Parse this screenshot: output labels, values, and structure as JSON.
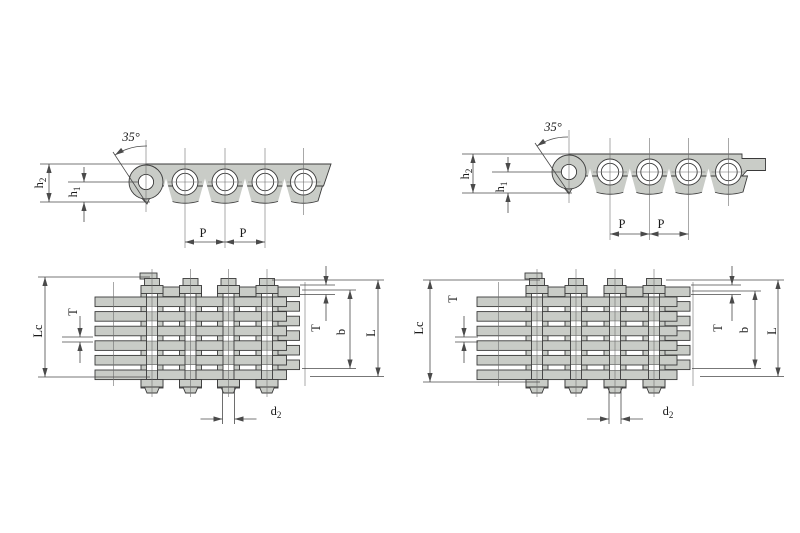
{
  "colors": {
    "plate_fill": "#c9ccc7",
    "outline": "#3a3a3a",
    "dimension": "#4a4a4a",
    "centerline": "#6f6f6f",
    "background": "#ffffff"
  },
  "views": {
    "side_left": {
      "angle": "35°",
      "h2_base": "h",
      "h2_sub": "2",
      "h1_base": "h",
      "h1_sub": "1",
      "pitch1": "P",
      "pitch2": "P"
    },
    "side_right": {
      "angle": "35°",
      "h2_base": "h",
      "h2_sub": "2",
      "h1_base": "h",
      "h1_sub": "1",
      "pitch1": "P",
      "pitch2": "P"
    },
    "plan_left": {
      "lc": "Lc",
      "t_left": "T",
      "t_right": "T",
      "b": "b",
      "l": "L",
      "d2_base": "d",
      "d2_sub": "2"
    },
    "plan_right": {
      "lc": "Lc",
      "t_left": "T",
      "t_right": "T",
      "b": "b",
      "l": "L",
      "d2_base": "d",
      "d2_sub": "2"
    }
  }
}
